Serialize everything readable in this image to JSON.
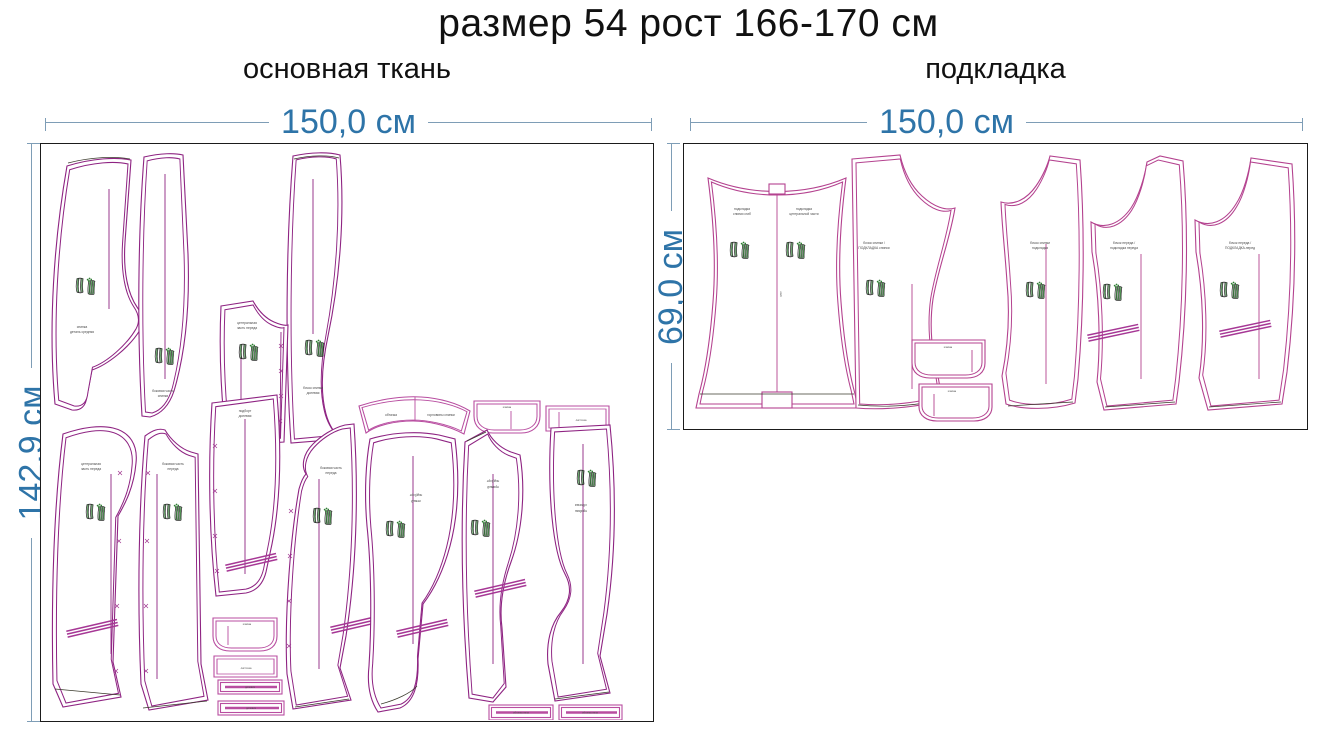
{
  "title": "размер 54 рост 166-170 см",
  "panels": {
    "main": {
      "subtitle": "основная ткань",
      "width_label": "150,0 см",
      "height_label": "142,9 см",
      "pieces": [
        {
          "name": "center-back",
          "l1": "спинка",
          "l2": "деталь средняя"
        },
        {
          "name": "side-back",
          "l1": "боковая часть",
          "l2": "спинки"
        },
        {
          "name": "side-back-2",
          "l1": "бочок спинки",
          "l2": "долевая"
        },
        {
          "name": "front-facing",
          "l1": "центральная",
          "l2": "часть переда"
        },
        {
          "name": "neck-yoke",
          "l1": "обтачка",
          "l2": "горловины спинки"
        },
        {
          "name": "pocket-flap-small",
          "l1": "клапан"
        },
        {
          "name": "welt-rect",
          "l1": "листочка"
        },
        {
          "name": "front-left",
          "l1": "центральная",
          "l2": "часть переда"
        },
        {
          "name": "front-right",
          "l1": "боковая часть",
          "l2": "переда"
        },
        {
          "name": "side-front",
          "l1": "подборт",
          "l2": "долевая"
        },
        {
          "name": "flap",
          "l1": "клапан"
        },
        {
          "name": "pocket-welt",
          "l1": "листочка"
        },
        {
          "name": "strip-1",
          "l1": "долевик"
        },
        {
          "name": "strip-2",
          "l1": "долевик"
        },
        {
          "name": "side-piece",
          "l1": "боковая часть",
          "l2": "переда"
        },
        {
          "name": "under-facing-left",
          "l1": "подборт",
          "l2": "левый"
        },
        {
          "name": "under-facing-right",
          "l1": "подборт",
          "l2": "правый"
        },
        {
          "name": "armhole-facing",
          "l1": "обтачка",
          "l2": "проймы"
        },
        {
          "name": "strip-3",
          "l1": "обтачка низа"
        },
        {
          "name": "strip-4",
          "l1": "обтачка низа"
        }
      ]
    },
    "lining": {
      "subtitle": "подкладка",
      "width_label": "150,0 см",
      "height_label": "69,0 см",
      "fold_label": "сгиб",
      "pieces": [
        {
          "name": "back-lining-fold",
          "l1": "подкладка",
          "l2": "спинки сгиб",
          "l3": "подкладка",
          "l4": "центральной части"
        },
        {
          "name": "back-lining",
          "l1": "бочок спинки /",
          "l2": "ПОДКЛАДКА спинки"
        },
        {
          "name": "flap-lining-1",
          "l1": "клапан"
        },
        {
          "name": "flap-lining-2",
          "l1": "клапан"
        },
        {
          "name": "side-lining",
          "l1": "бочок спинки",
          "l2": "подкладка"
        },
        {
          "name": "front-lining-1",
          "l1": "бочок переда /",
          "l2": "подкладка переда"
        },
        {
          "name": "front-lining-2",
          "l1": "бочок переда /",
          "l2": "ПОДКЛАДКА-перед"
        }
      ]
    }
  },
  "colors": {
    "dimension_text": "#2e74a8",
    "dimension_line": "#7e9db6",
    "outline_main": "#8e2382",
    "outline_light": "#b84da0",
    "outline_lining": "#b4428f",
    "logo_green": "#2e7d32",
    "panel_border": "#1b1b1b"
  }
}
